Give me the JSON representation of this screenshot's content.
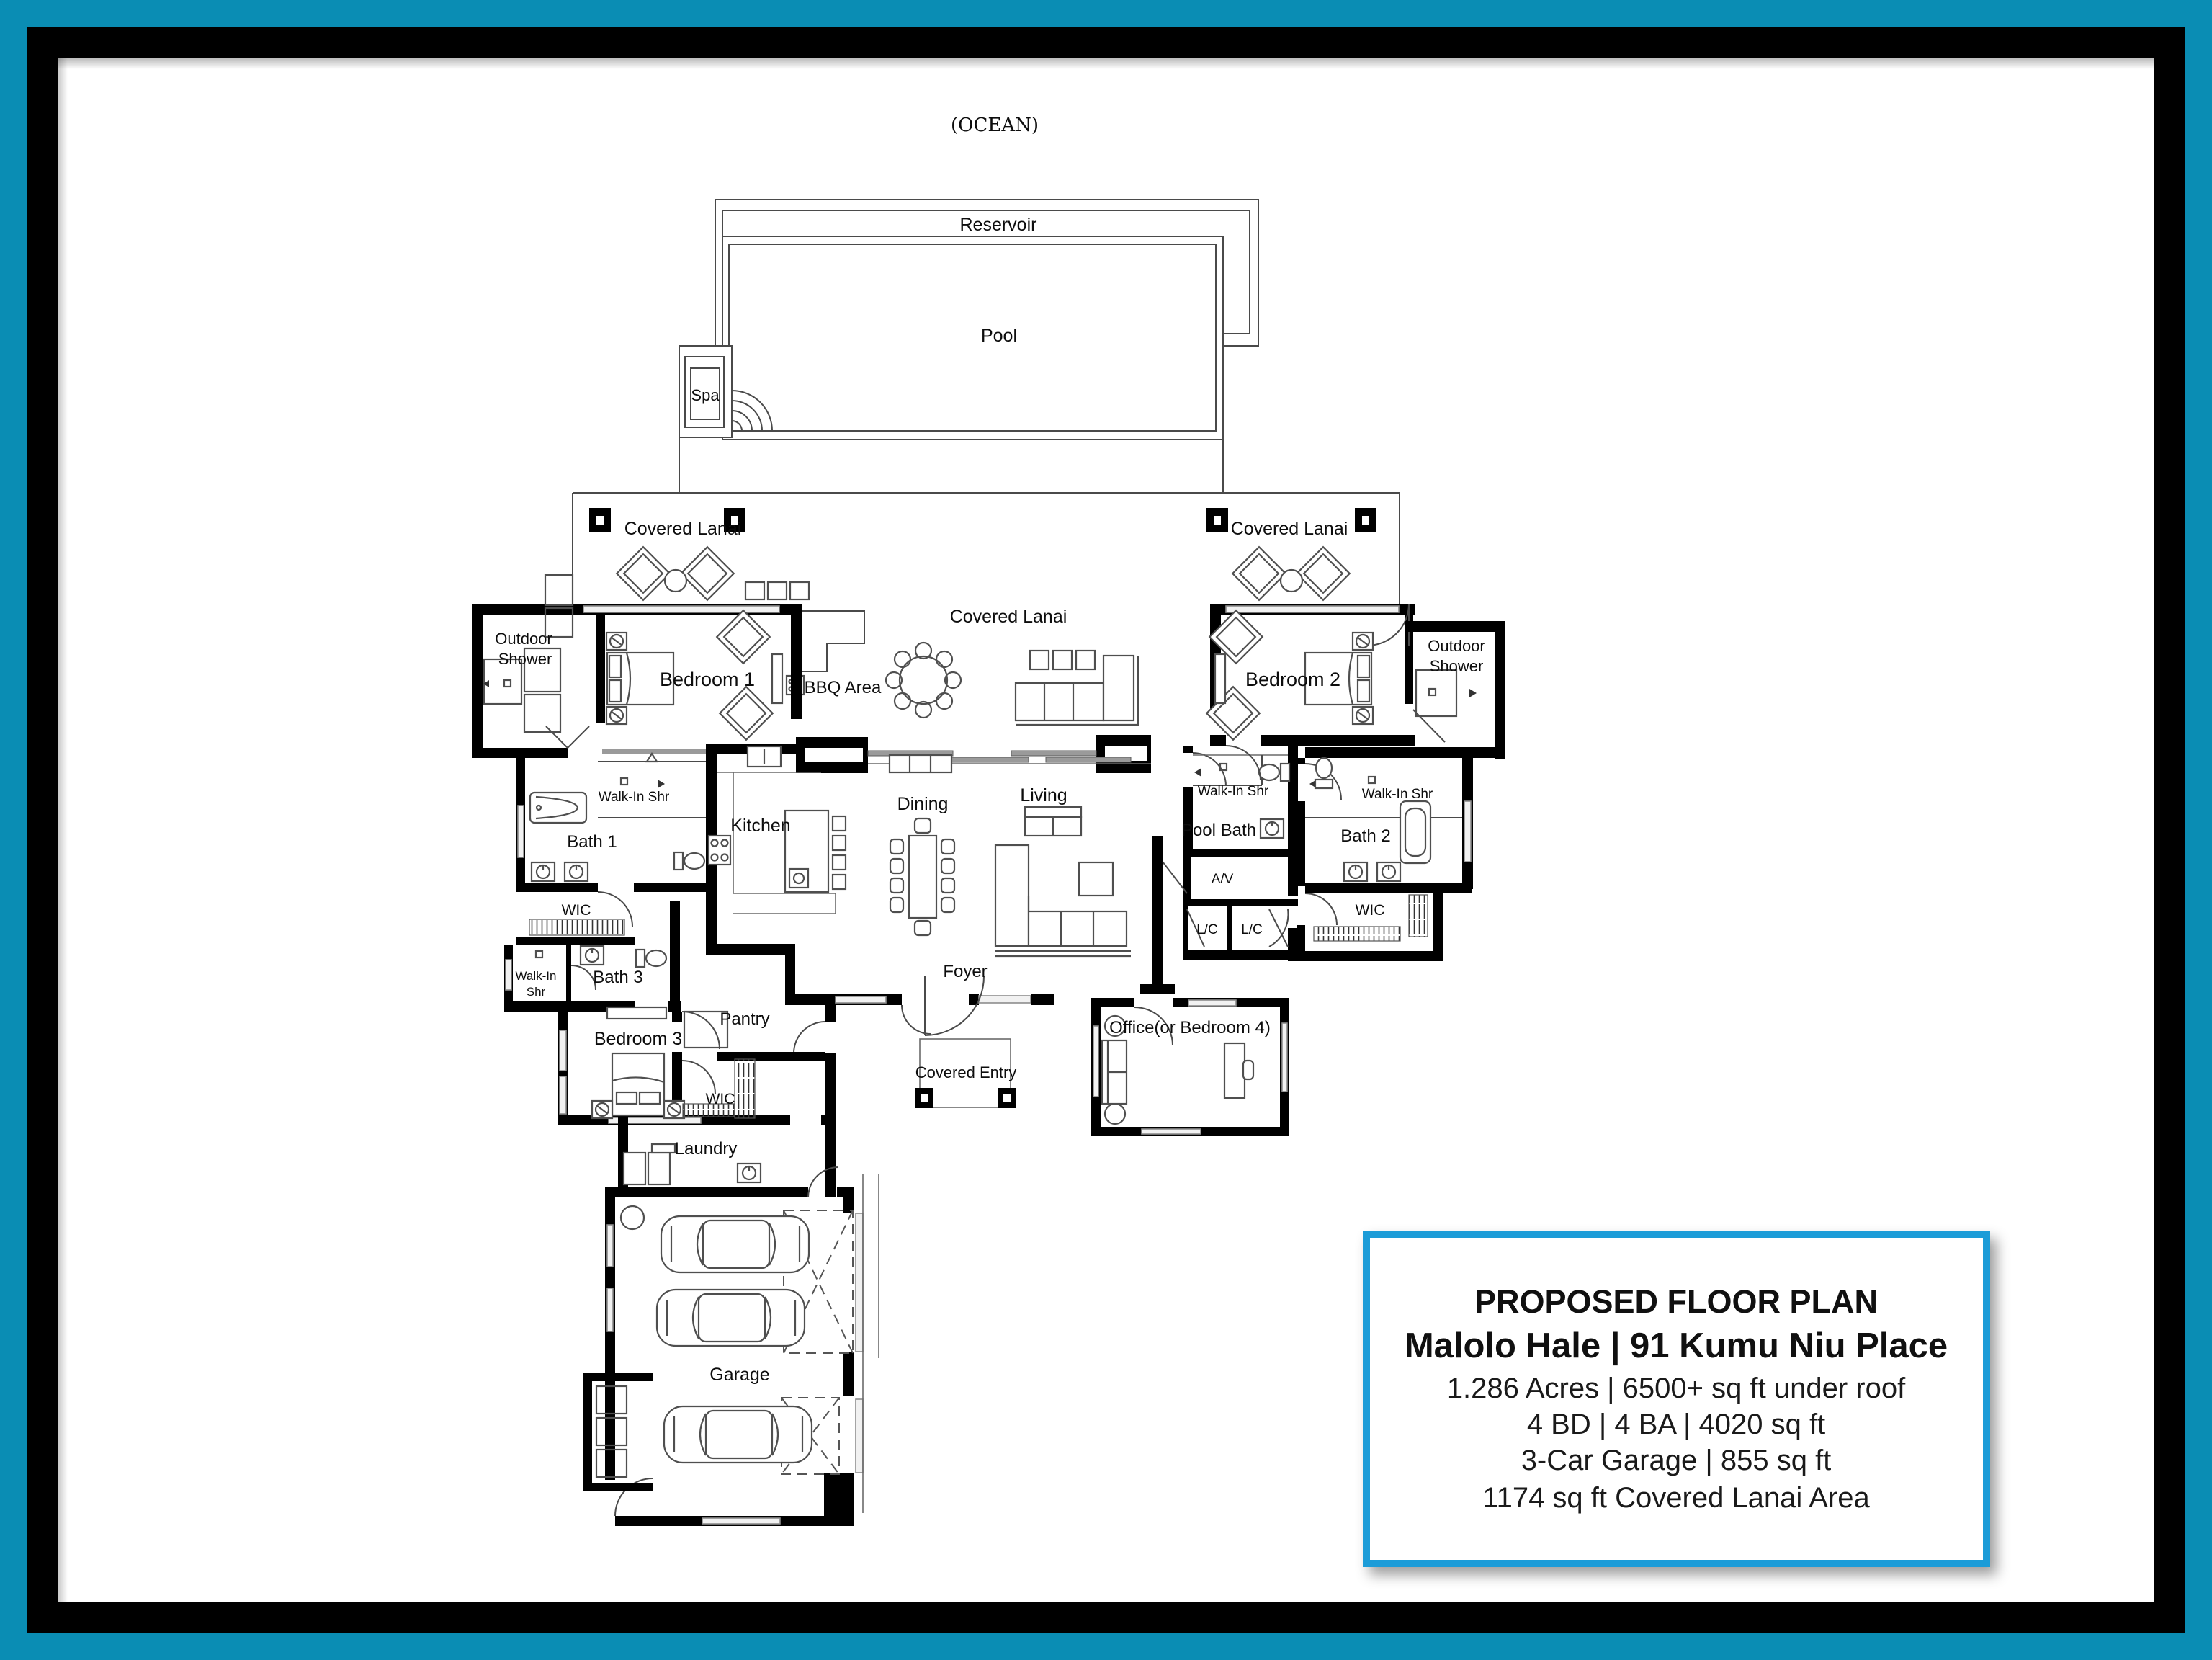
{
  "frame": {
    "teal": "#0a8db4",
    "black": "#000000",
    "paper": "#ffffff"
  },
  "site": {
    "ocean": "(OCEAN)",
    "reservoir": "Reservoir",
    "pool": "Pool",
    "spa": "Spa"
  },
  "rooms": {
    "covered_lanai": "Covered Lanai",
    "outdoor_shower_line1": "Outdoor",
    "outdoor_shower_line2": "Shower",
    "bedroom1": "Bedroom 1",
    "bedroom2": "Bedroom 2",
    "bedroom3": "Bedroom 3",
    "bbq_area": "BBQ Area",
    "kitchen": "Kitchen",
    "dining": "Dining",
    "living": "Living",
    "pool_bath": "Pool Bath",
    "walk_in_shr": "Walk-In Shr",
    "walk_in_line1": "Walk-In",
    "walk_in_line2": "Shr",
    "bath1": "Bath 1",
    "bath2": "Bath 2",
    "bath3": "Bath 3",
    "wic": "WIC",
    "av": "A/V",
    "lc": "L/C",
    "pantry": "Pantry",
    "laundry": "Laundry",
    "foyer": "Foyer",
    "covered_entry": "Covered Entry",
    "office": "Office(or Bedroom 4)",
    "garage": "Garage"
  },
  "infobox": {
    "border_color": "#1b9cd8",
    "title": "PROPOSED FLOOR PLAN",
    "subtitle": "Malolo Hale | 91 Kumu Niu Place",
    "line1": "1.286 Acres | 6500+ sq ft under roof",
    "line2": "4 BD | 4 BA | 4020 sq ft",
    "line3": "3-Car Garage | 855 sq ft",
    "line4": "1174 sq ft Covered Lanai Area"
  }
}
